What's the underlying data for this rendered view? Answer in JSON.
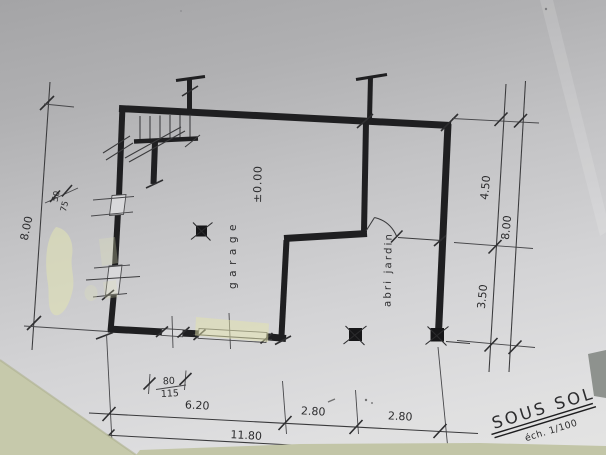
{
  "plan": {
    "title": "SOUS SOL",
    "scale_note": "éch. 1/100",
    "room_garage": "garage",
    "room_abri": "abri jardin",
    "level": "±0.00",
    "dim_left_total": "8.00",
    "dim_right_upper": "4.50",
    "dim_right_lower": "3.50",
    "dim_right_total": "8.00",
    "dim_bottom_1": "6.20",
    "dim_bottom_2": "2.80",
    "dim_bottom_3": "2.80",
    "dim_bottom_total": "11.80",
    "dim_detail_w": "80",
    "dim_detail_h": "115",
    "dim_detail_a": "50",
    "dim_detail_b": "75"
  },
  "colors": {
    "ink": "#232325",
    "paper": "#d4d4d6",
    "highlighter": "#dfe1b5",
    "table": "#c5c8a9"
  }
}
